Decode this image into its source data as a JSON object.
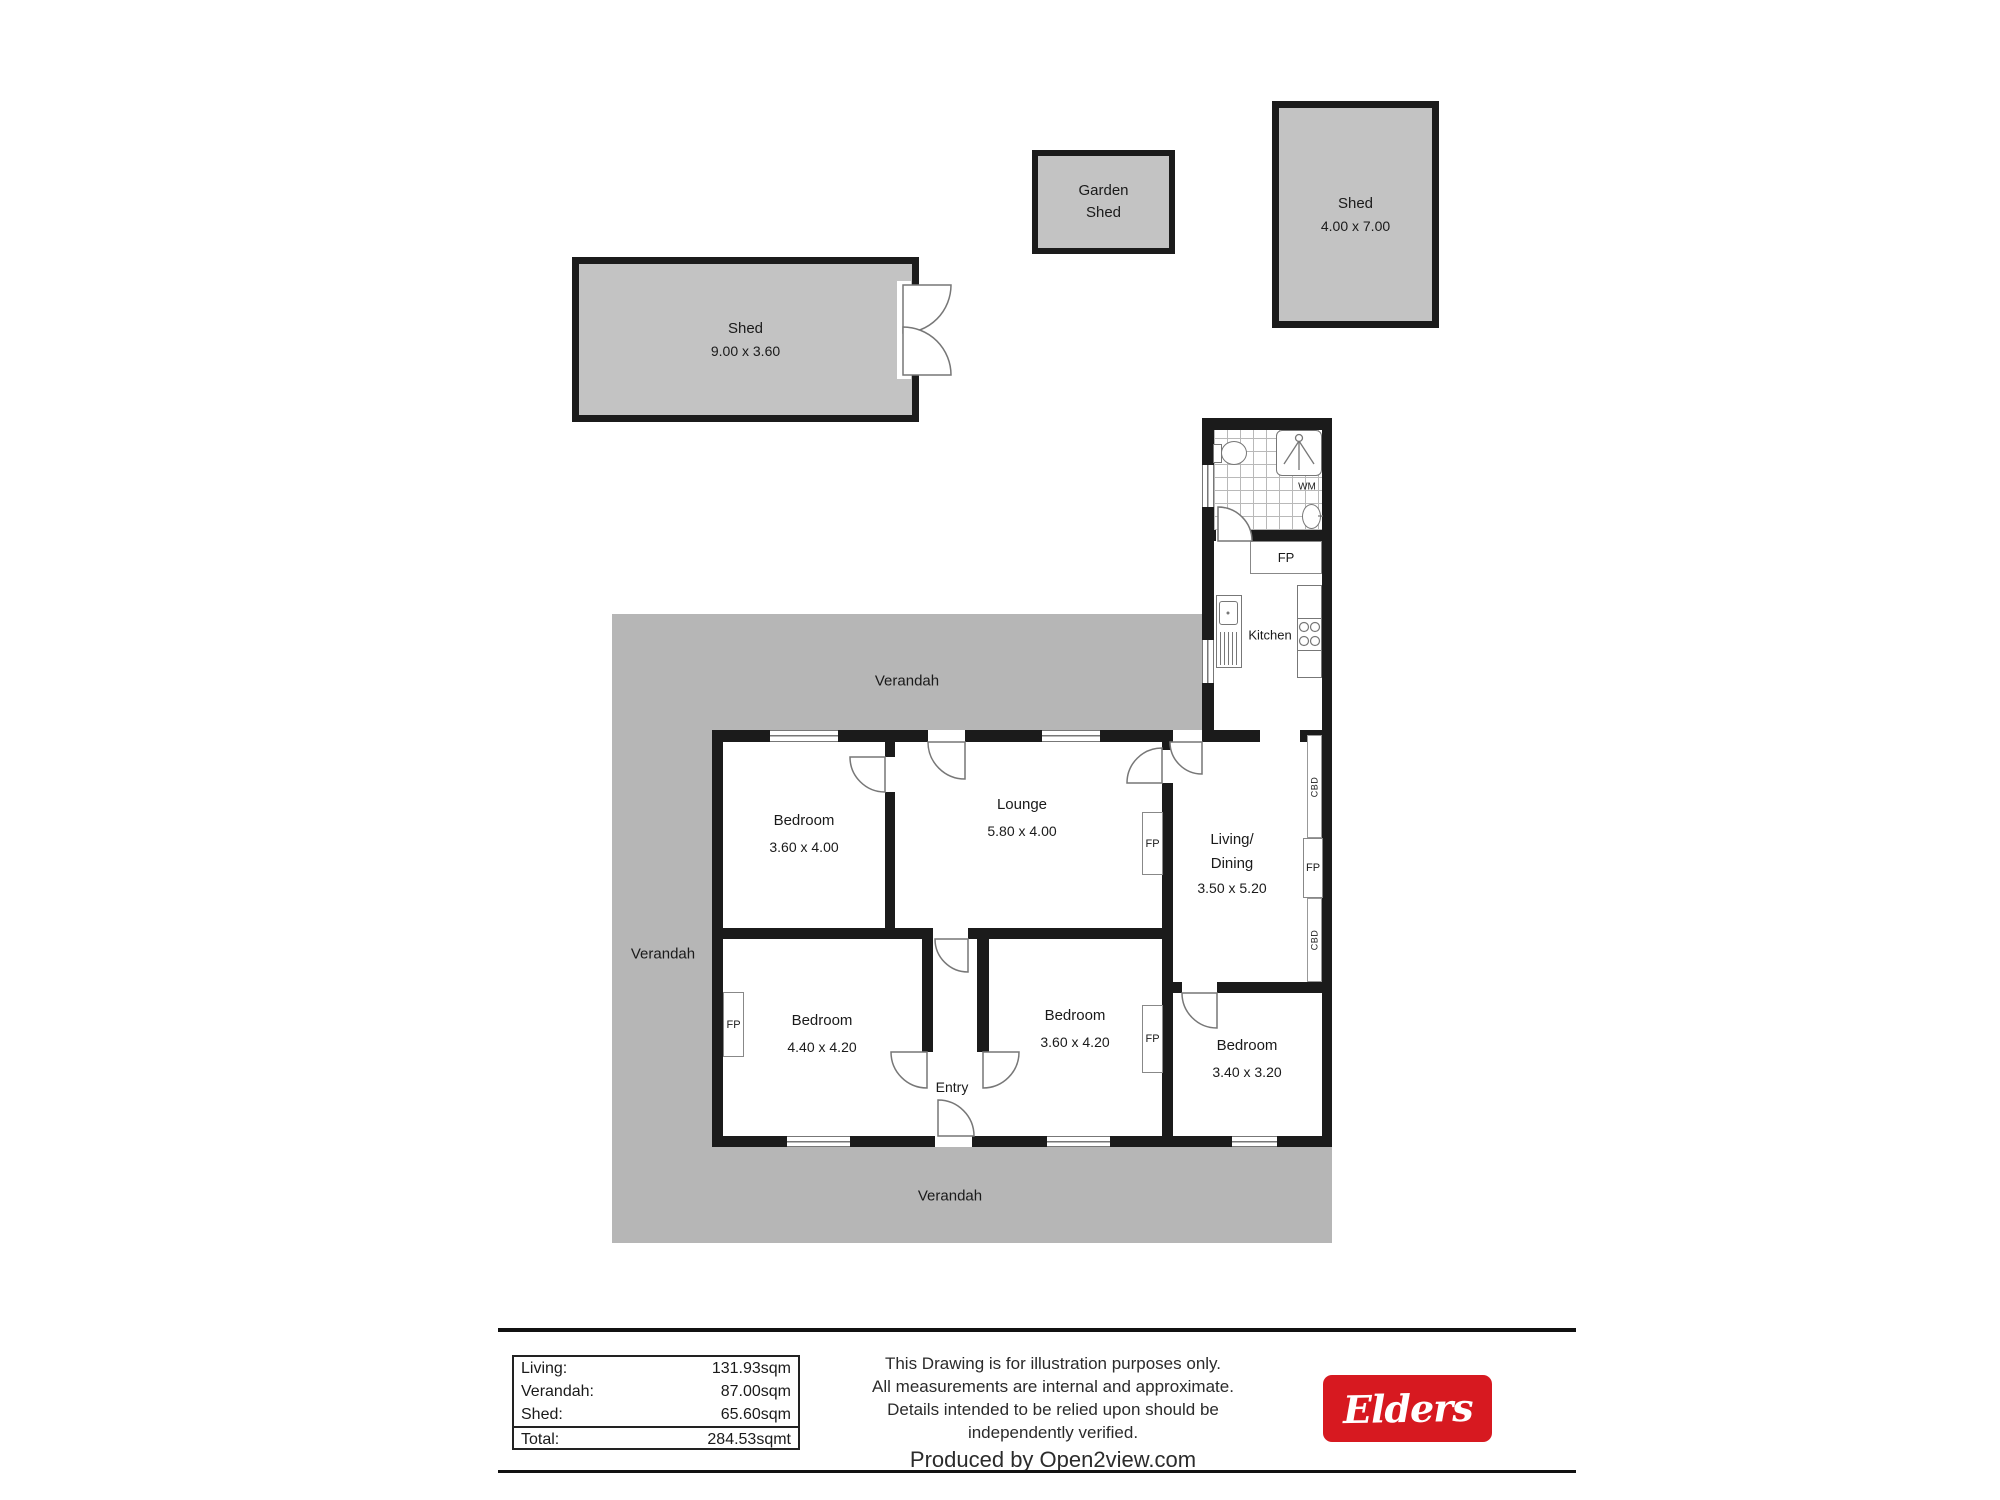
{
  "plan": {
    "structures": {
      "garden_shed": {
        "line1": "Garden",
        "line2": "Shed"
      },
      "shed_wide": {
        "name": "Shed",
        "dims": "9.00 x 3.60"
      },
      "shed_tall": {
        "name": "Shed",
        "dims": "4.00 x 7.00"
      }
    },
    "verandah": {
      "top": "Verandah",
      "left": "Verandah",
      "bottom": "Verandah"
    },
    "rooms": {
      "bedroom_top": {
        "name": "Bedroom",
        "dims": "3.60 x 4.00"
      },
      "lounge": {
        "name": "Lounge",
        "dims": "5.80 x 4.00"
      },
      "living_dining": {
        "name_line1": "Living/",
        "name_line2": "Dining",
        "dims": "3.50 x 5.20"
      },
      "kitchen": {
        "name": "Kitchen"
      },
      "bedroom_left": {
        "name": "Bedroom",
        "dims": "4.40 x 4.20"
      },
      "bedroom_mid": {
        "name": "Bedroom",
        "dims": "3.60 x 4.20"
      },
      "bedroom_right": {
        "name": "Bedroom",
        "dims": "3.40 x 3.20"
      },
      "entry": {
        "name": "Entry"
      }
    },
    "fixtures": {
      "fireplace": "FP",
      "cupboard": "CBD",
      "washing_machine": "WM"
    },
    "colors": {
      "wall": "#1b1b1b",
      "verandah_fill": "#b6b6b6",
      "shed_fill": "#c3c3c3"
    }
  },
  "footer": {
    "areas": {
      "rows": [
        {
          "label": "Living:",
          "value": "131.93sqm"
        },
        {
          "label": "Verandah:",
          "value": "87.00sqm"
        },
        {
          "label": "Shed:",
          "value": "65.60sqm"
        }
      ],
      "total": {
        "label": "Total:",
        "value": "284.53sqmt"
      }
    },
    "disclaimer": {
      "line1": "This Drawing is for illustration purposes only.",
      "line2": "All measurements are internal and  approximate.",
      "line3": "Details intended to be relied upon should be",
      "line4": "independently verified.",
      "produced_by": "Produced by Open2view.com"
    },
    "brand": {
      "name": "Elders",
      "background": "#D71920"
    }
  }
}
